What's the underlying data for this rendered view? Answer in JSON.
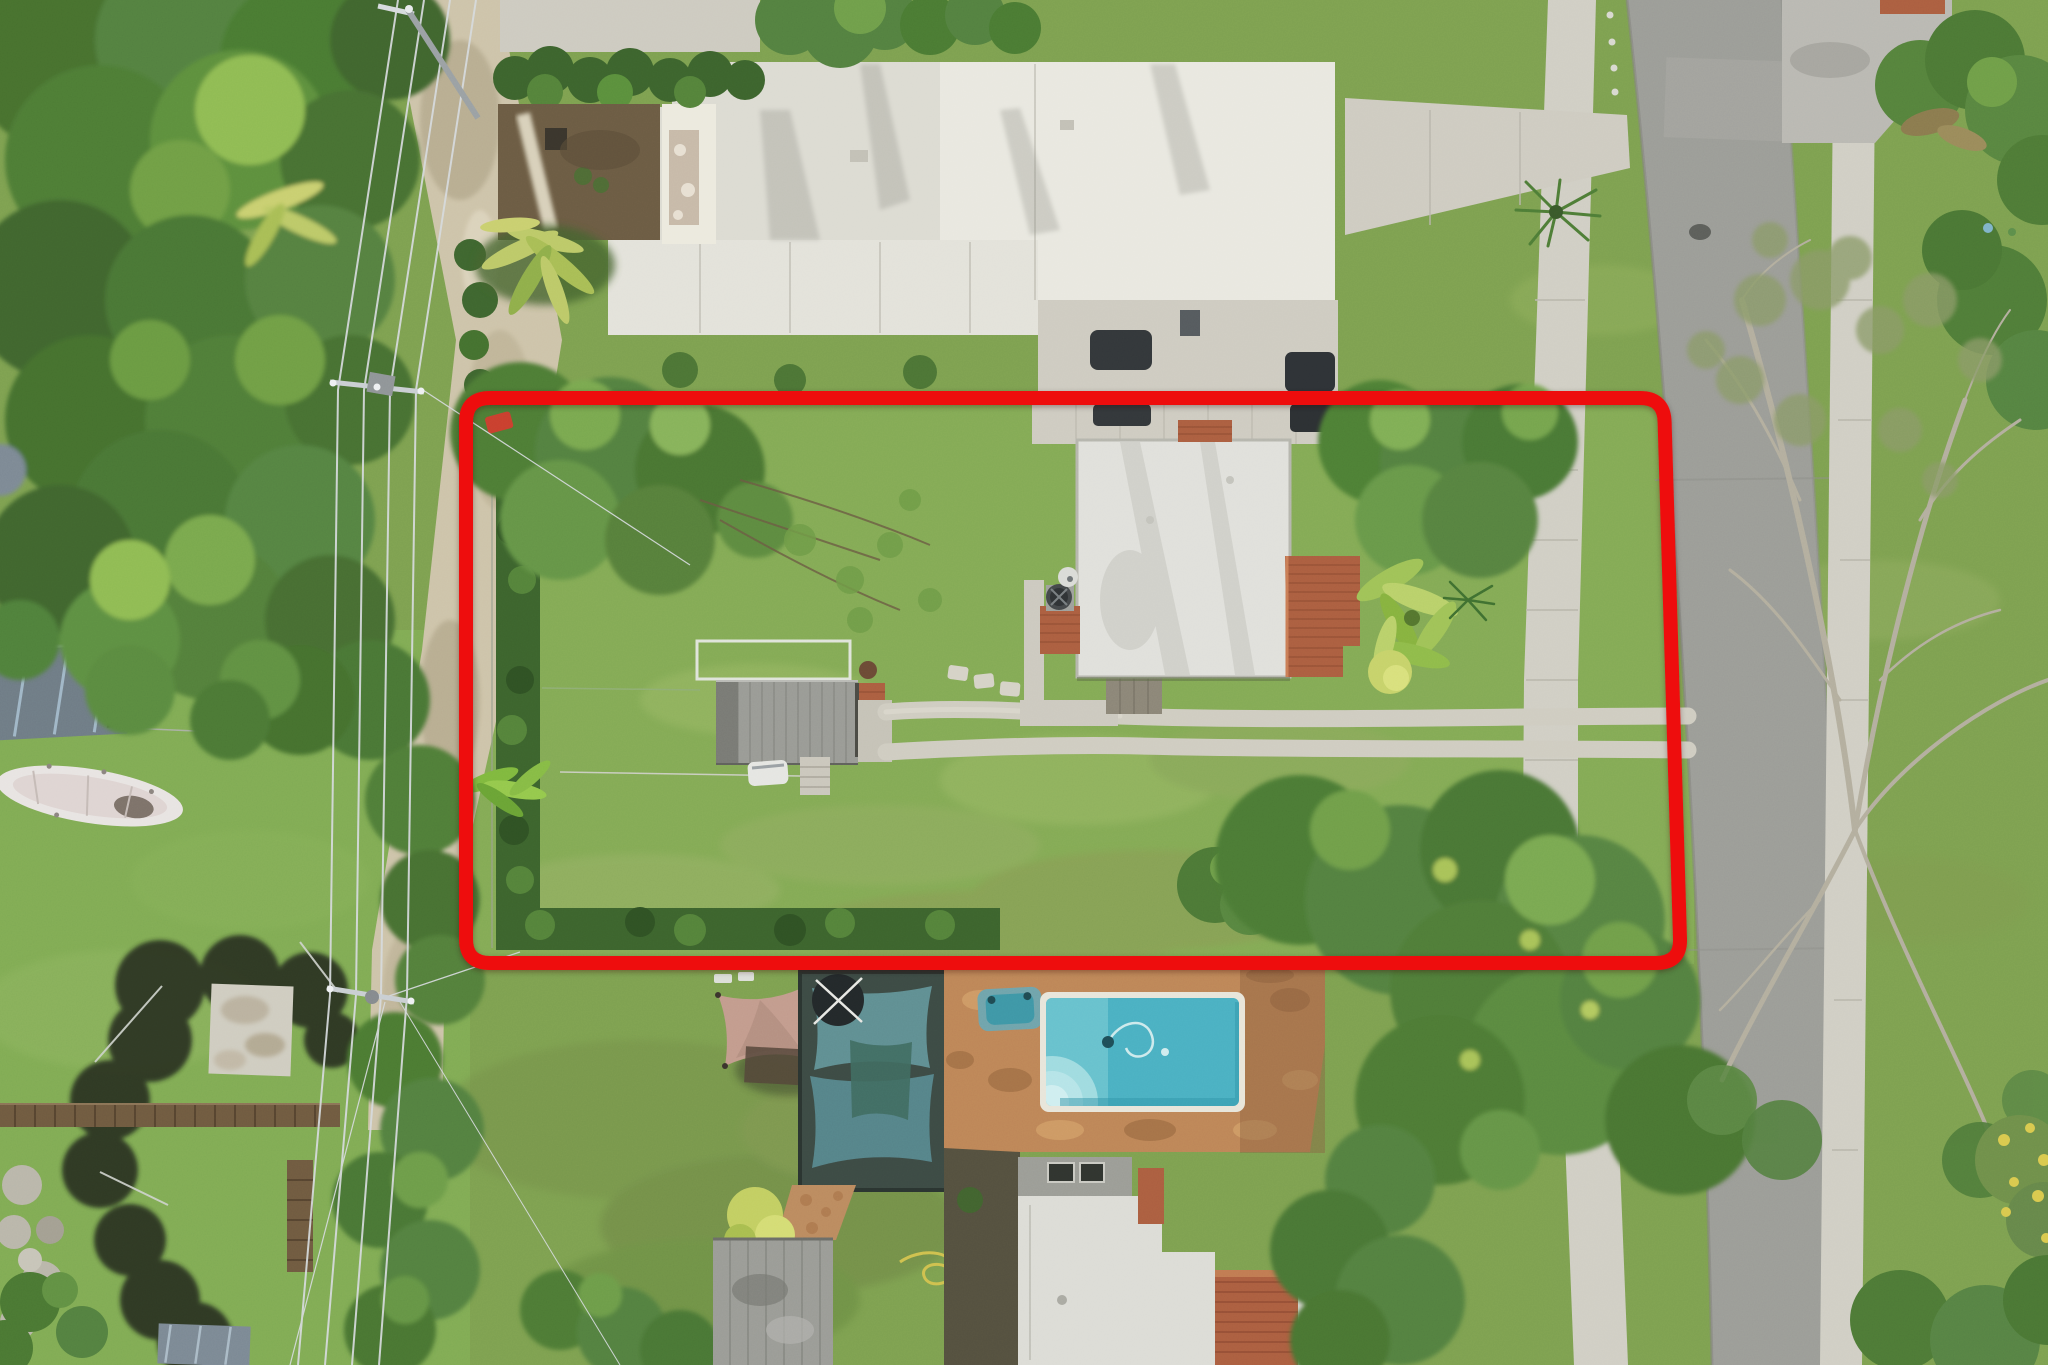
{
  "image": {
    "type": "aerial-drone-photograph",
    "description": "Overhead aerial drone photo of a suburban residential lot outlined with a thick red property-boundary rectangle. Inside the boundary: a white flat-roof house with terracotta tile sections, a gray shed with tile edge, a large grassy yard, hedges, trees and a double-track driveway leading to the street on the right. Surroundings: a large white modern house to the north, a dirt alley and dense tree canopy with power lines on the left, a neighbor's backyard with shade sails, brick pool deck, swimming pool and spa below, and a street with sidewalks and a large bare-branched tree on the right.",
    "width_px": 2048,
    "height_px": 1365
  },
  "annotation": {
    "name": "property-boundary-outline",
    "shape": "rounded-rectangle",
    "color": "#ee1111",
    "stroke_width_px": 14,
    "left_px": 466,
    "top_px": 398,
    "right_top_px": 1664,
    "right_bottom_px": 1680,
    "bottom_px": 963
  },
  "colors": {
    "lawn_base": "#7da050",
    "lot_lawn": "#83aa55",
    "lawn_light": "#9ab865",
    "lawn_worn": "#8a9a55",
    "backyard_worn": "#75904a",
    "canopy_dark": "#3f652f",
    "canopy_mid": "#538040",
    "canopy_light": "#6f9e4a",
    "canopy_lime": "#8fbb52",
    "palm_yellow": "#bcc968",
    "hedge": "#3c632d",
    "dirt_path": "#cdc3a9",
    "dirt_yard": "#6b5b43",
    "street": "#9b9c97",
    "sidewalk": "#d0cec4",
    "driveway": "#cecbc1",
    "white_roof": "#dcdbd2",
    "white_roof_bright": "#e9e8e0",
    "subject_roof": "#e0e0db",
    "terracotta": "#ab5e40",
    "tile_line": "#8a4830",
    "shed_gray": "#999a95",
    "carport_blue": "#6e7b85",
    "pool_coping": "#e8e5da",
    "pool_water": "#4ab0c2",
    "pool_shallow": "#6cc4cf",
    "pool_steps": "#9fdbe0",
    "spa_water": "#3e96a6",
    "deck_paver": "#bd8557",
    "deck_light": "#d3a069",
    "deck_dark": "#9e6c44",
    "teal_sail": "#5f8e92",
    "teal_sail2": "#558389",
    "sail_frame": "#3c4a44",
    "tan_sail": "#c29b8d",
    "boat_white": "#e8e4e2",
    "net_dark": "#20261f",
    "wood_fence": "#6f5a40",
    "concrete_pad": "#cfccc0",
    "gray_structure": "#9a9b96",
    "south_roof_white": "#dcdcd6",
    "parapet_gray": "#9b9c96",
    "skylight": "#30342f",
    "mulch": "#54503f",
    "wire": "#d6dadd",
    "pole_gray": "#9aa0a3",
    "branch_pale": "#b3ae9e",
    "bare_foliage": "#8a9a68",
    "hose_yellow": "#cfc04e",
    "mower_red": "#c93f2e",
    "car_dark": "#33373a",
    "umbrella_white": "#e6e4dc",
    "manhole": "#5c5e5a"
  },
  "scene": {
    "subject_lot": "red outlined property with white flat-roof house, tile roof sections, gray shed, lawn, hedges, double-track driveway",
    "north_neighbor": "large white modern flat-roof house with stepped parapets, hedge row, dirt side yard, paver courtyard, driveway to street",
    "west_area": "dense tree canopy, dirt alley, power lines with poles, metal carport, white boat on grass, black batting net, concrete pad, wooden fences",
    "south_neighbor": "backyard with tan shade sail, teal shade-sail canopy, brick paver pool deck, turquoise swimming pool with steps, spa, white roof house with skylights and tile roof",
    "east_area": "street, sidewalks, grass parkways, palm, large bare-branched tree, green trees, manhole cover"
  }
}
